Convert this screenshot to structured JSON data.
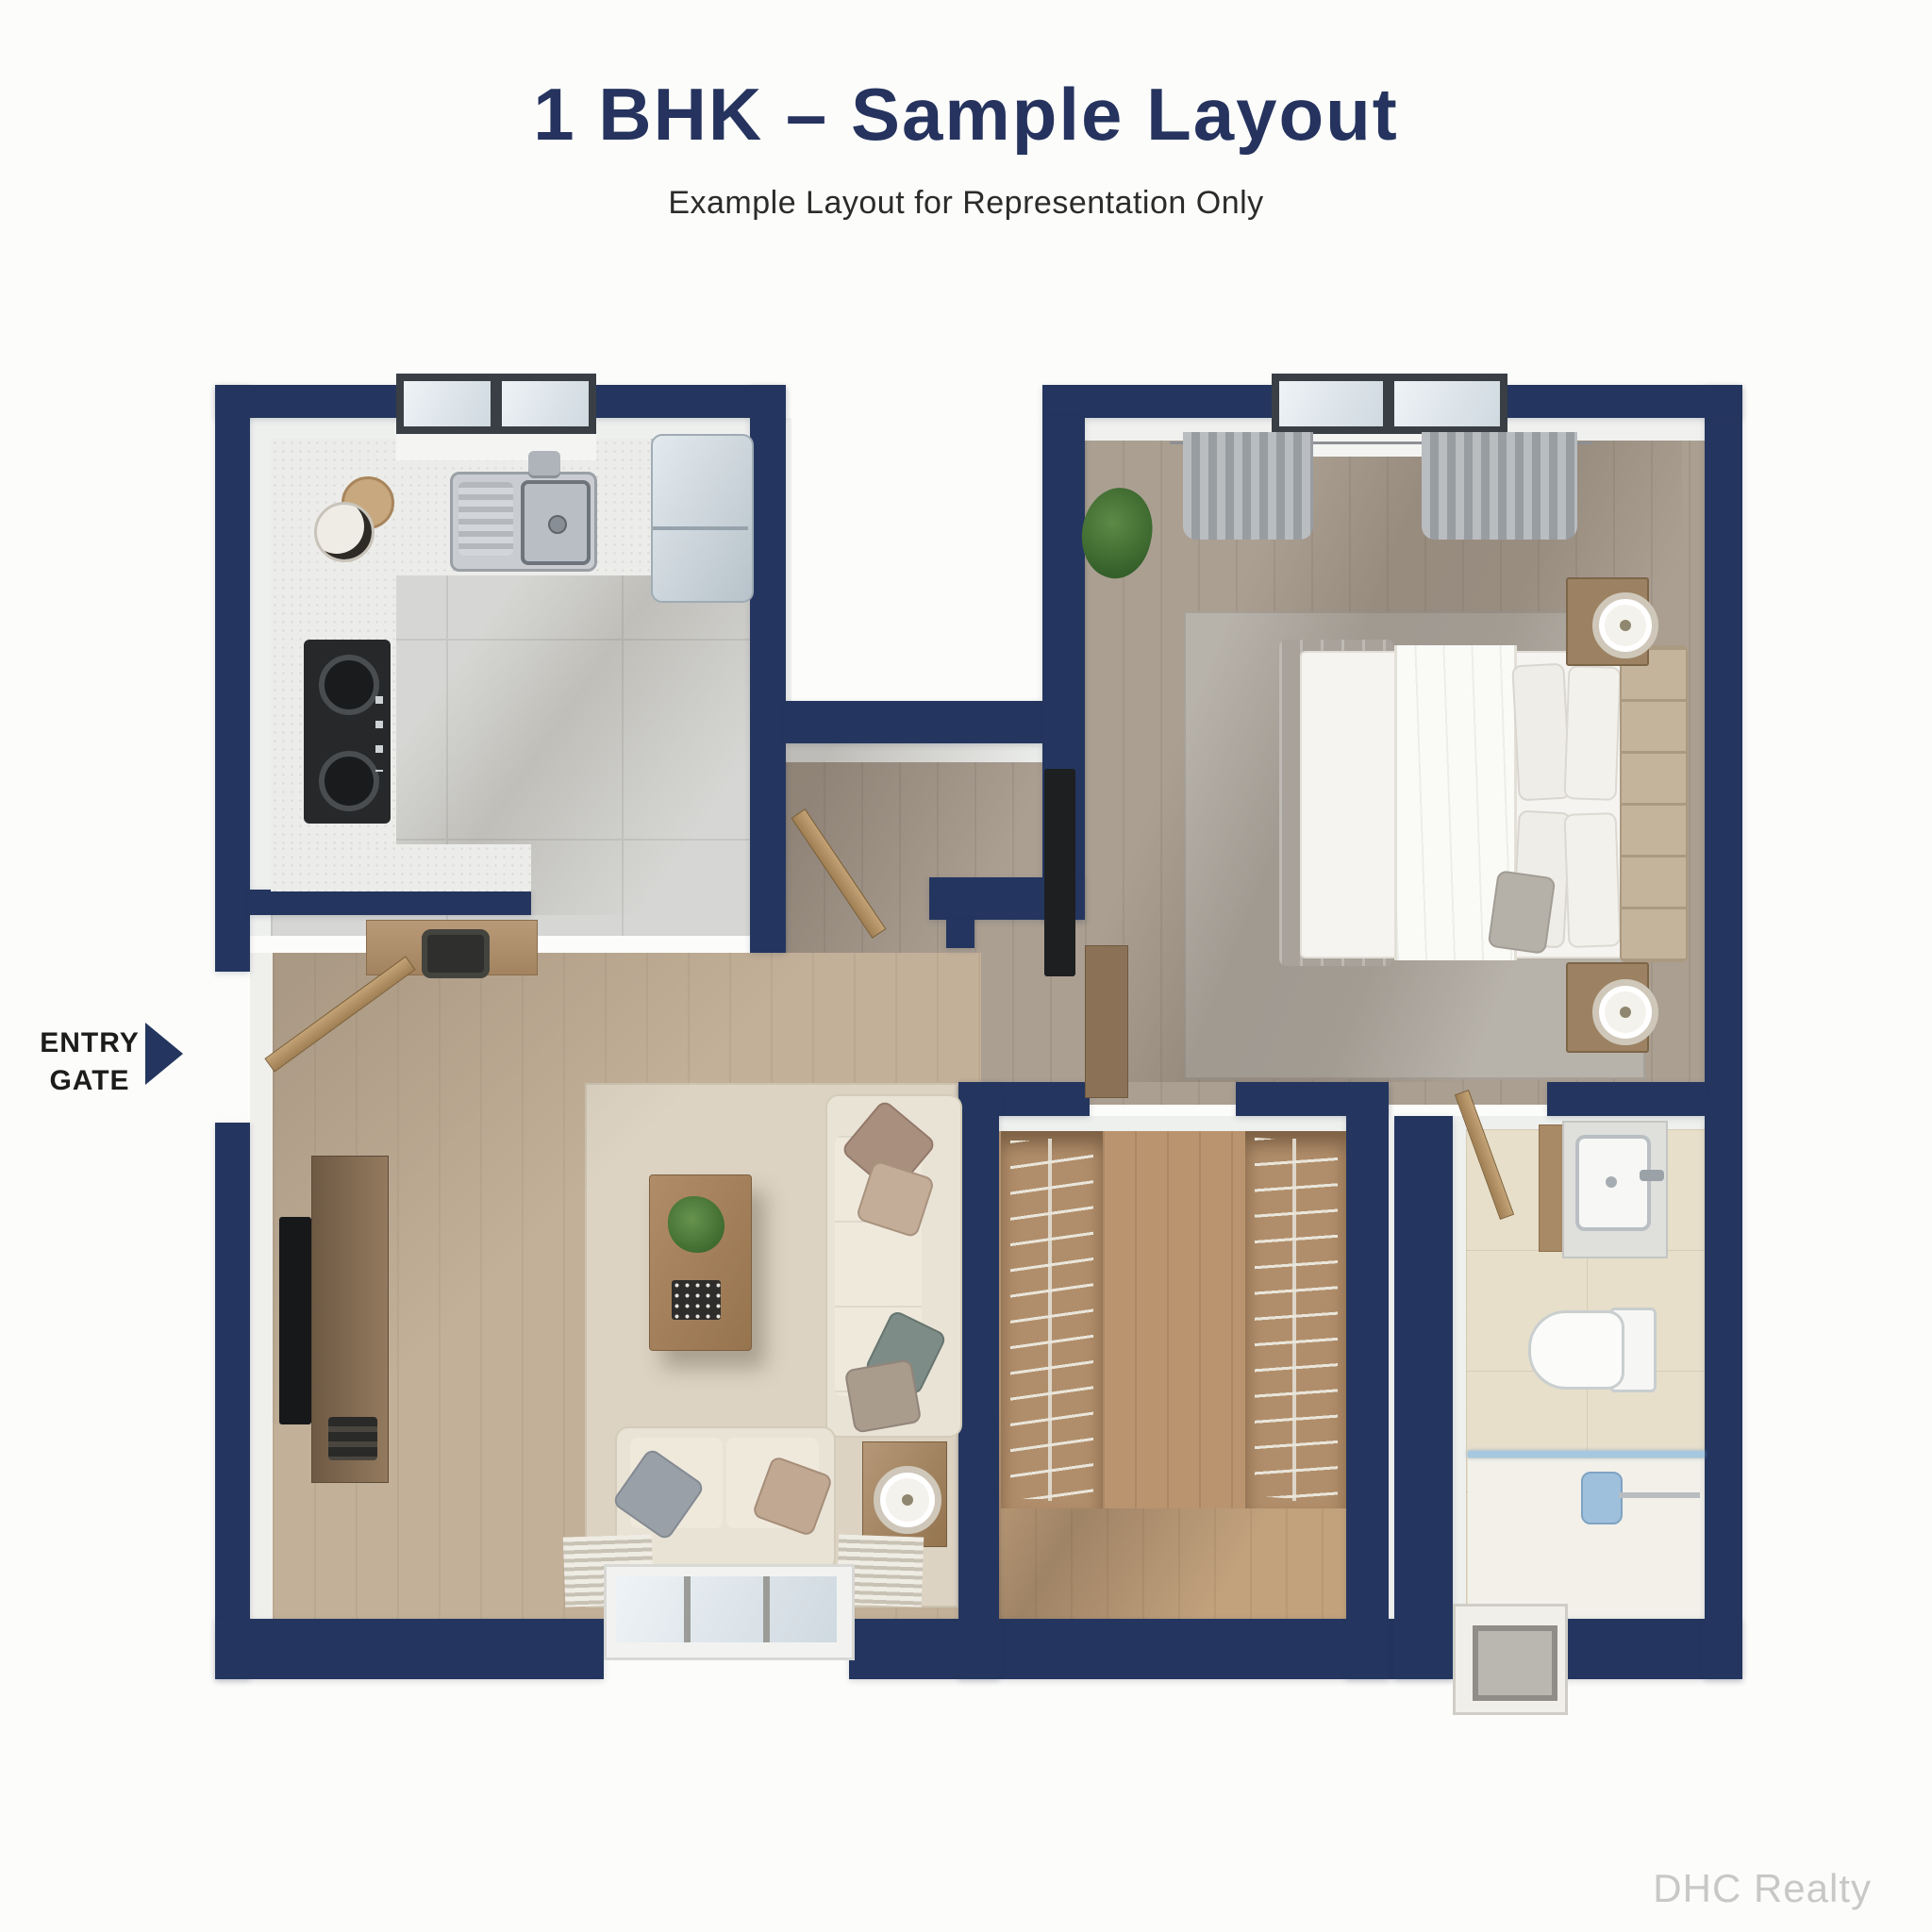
{
  "header": {
    "title": "1 BHK – Sample Layout",
    "subtitle": "Example Layout for Representation Only"
  },
  "entry_gate": {
    "line1": "ENTRY",
    "line2": "GATE"
  },
  "watermark": "DHC Realty",
  "colors": {
    "bg": "#fcfcfa",
    "wall": "#24365f",
    "title": "#25335e",
    "subtitle": "#2b2b29",
    "label": "#1c1c1a",
    "watermark": "#c8c8c6",
    "glass": "#a5c8e0",
    "wood-light": "#c3b098",
    "wood-gray": "#ab9f92",
    "wood-warm": "#c2a17d"
  },
  "plan": {
    "type": "apartment-floor-plan",
    "unit": "1 BHK",
    "rooms": [
      {
        "name": "kitchen",
        "furniture": [
          "window",
          "sink",
          "faucet",
          "gas-stove",
          "fridge",
          "countertop",
          "jars"
        ]
      },
      {
        "name": "living-room",
        "furniture": [
          "tv",
          "tv-console",
          "coffee-table",
          "plant",
          "l-sofa",
          "loveseat",
          "side-table",
          "lamp",
          "rug",
          "window",
          "desk",
          "chair",
          "entry-door"
        ]
      },
      {
        "name": "foyer",
        "furniture": [
          "door"
        ]
      },
      {
        "name": "bedroom",
        "furniture": [
          "window",
          "curtains",
          "plant",
          "double-bed",
          "headboard",
          "pillows",
          "nightstand-left",
          "nightstand-right",
          "table-lamps",
          "rug",
          "tv",
          "console"
        ]
      },
      {
        "name": "wardrobe-room",
        "furniture": [
          "wardrobe-left",
          "wardrobe-right",
          "hanger-rails"
        ]
      },
      {
        "name": "bathroom",
        "furniture": [
          "vanity",
          "washbasin",
          "faucet",
          "toilet",
          "shower",
          "glass-partition",
          "shower-drain",
          "door"
        ]
      }
    ]
  }
}
